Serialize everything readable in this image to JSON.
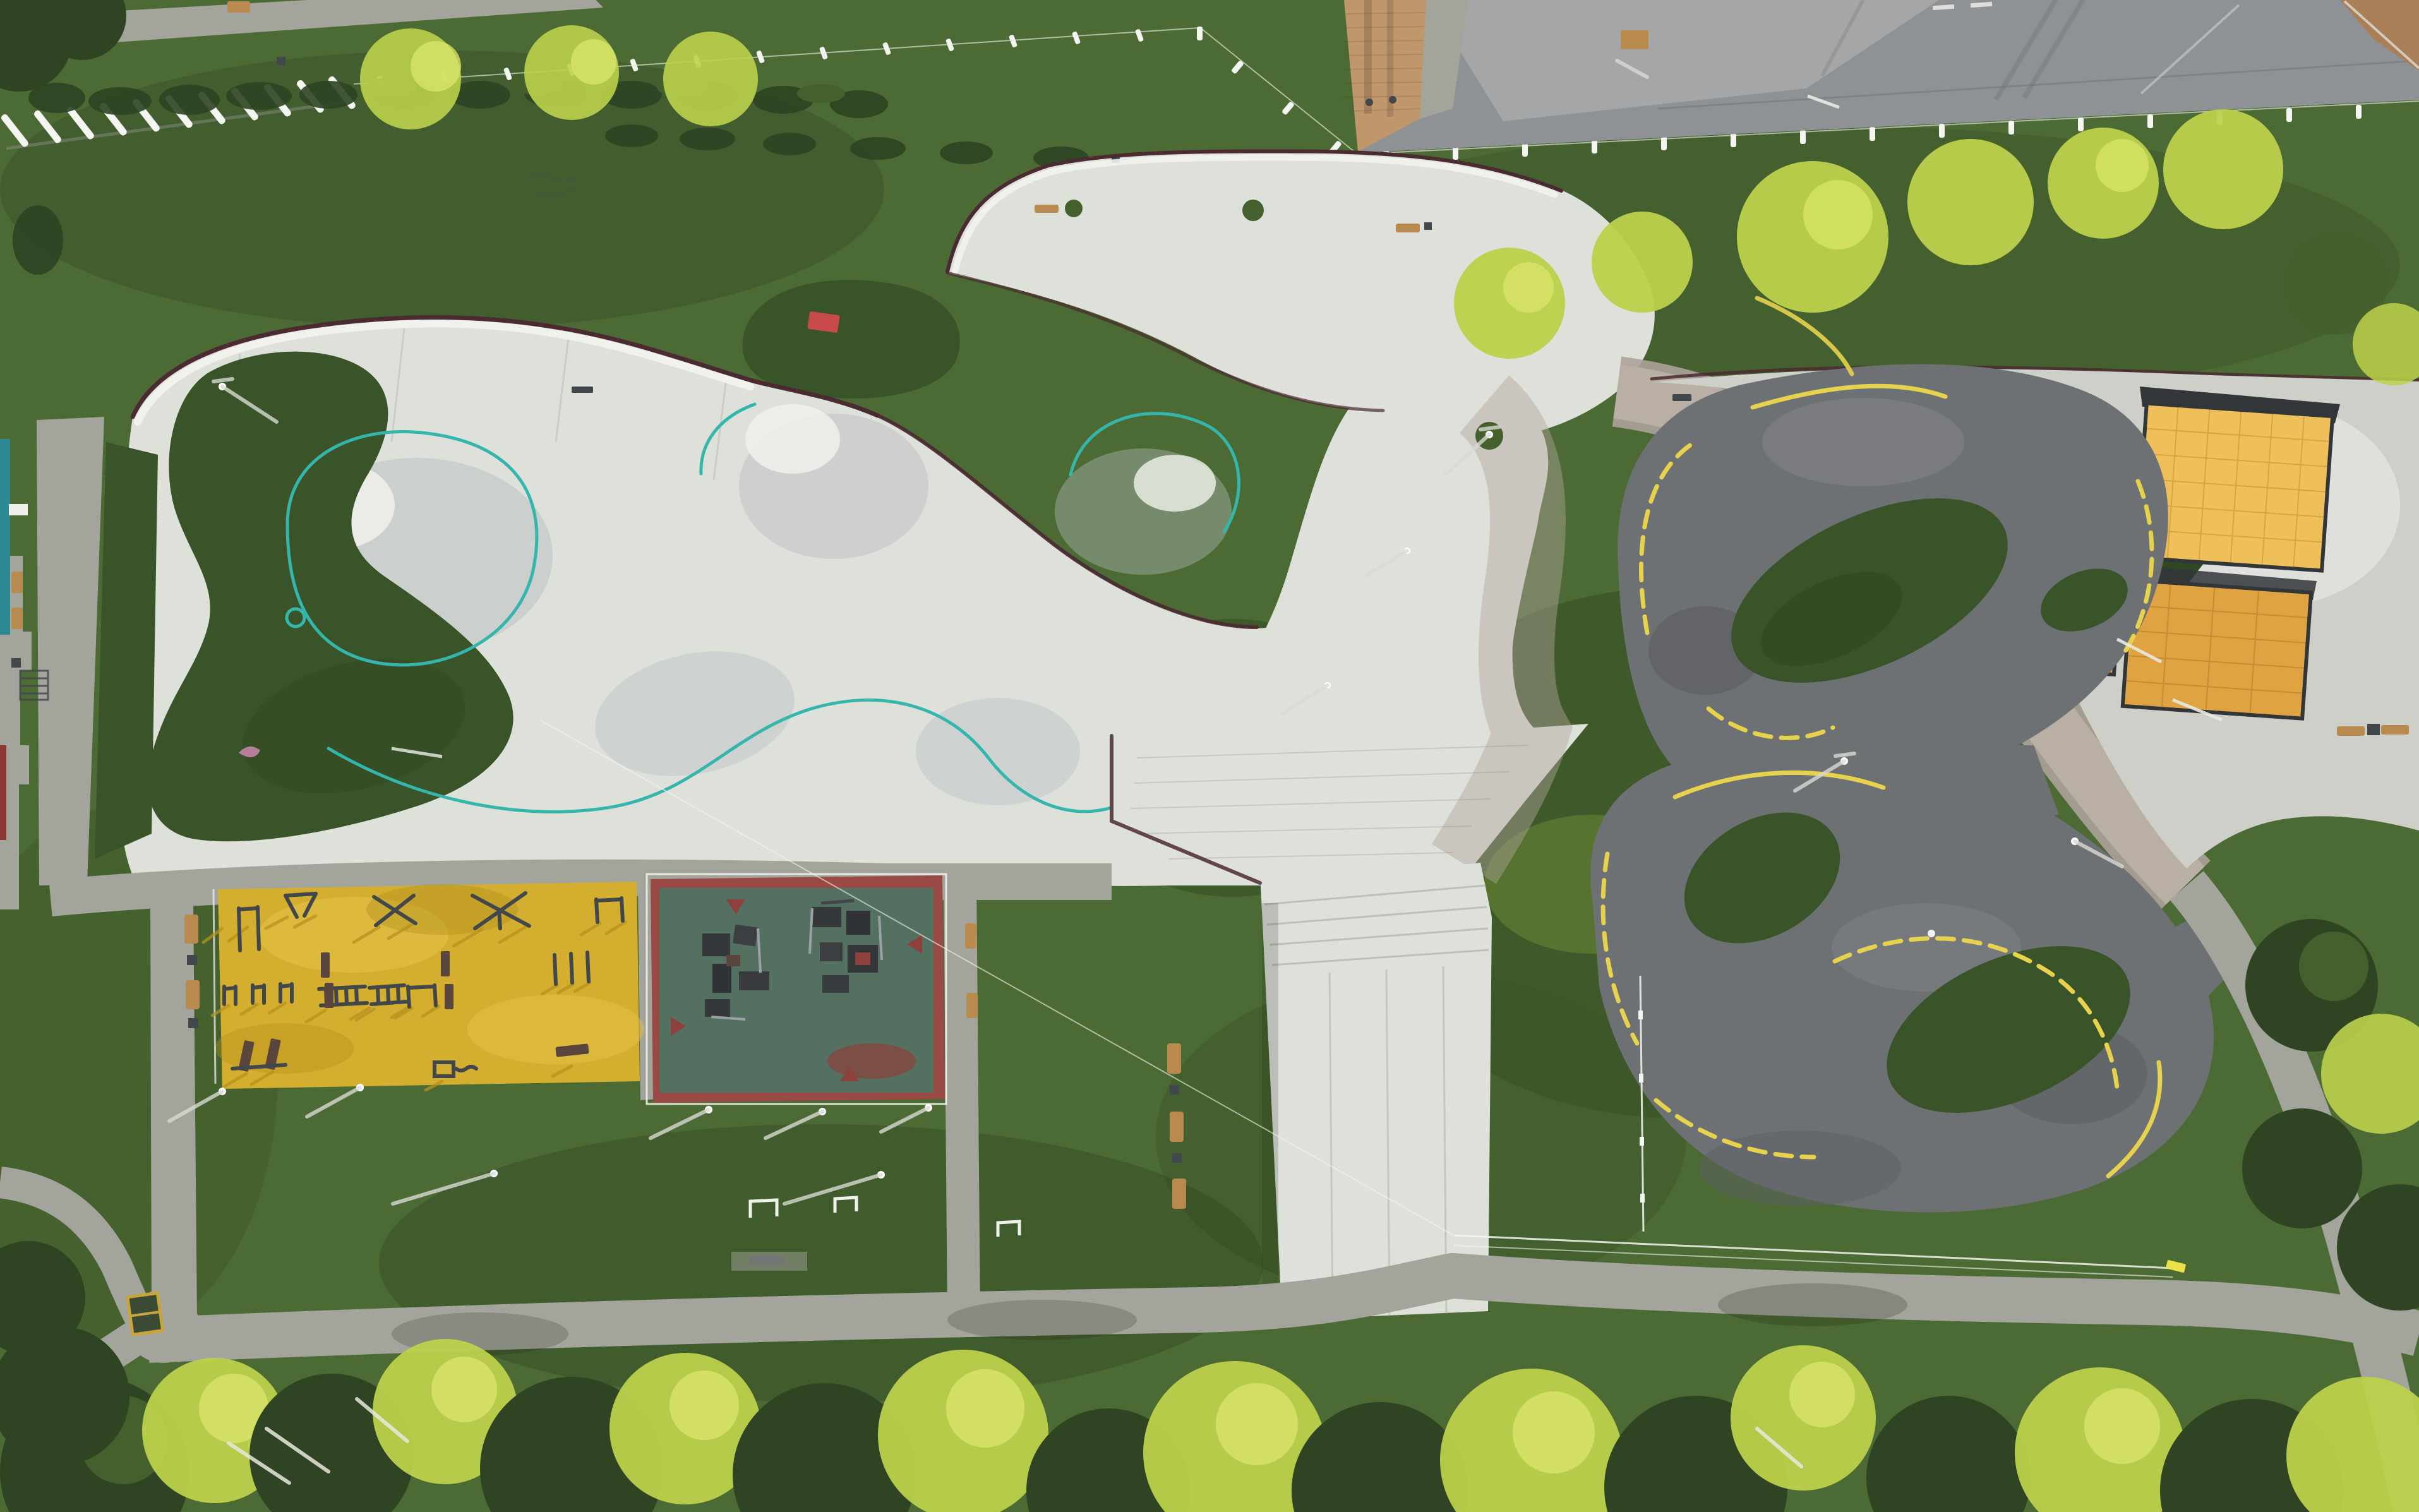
{
  "scene": {
    "type": "aerial-drone-photograph",
    "setting": "Top-down aerial view of an urban activity park: concrete skatepark with teal bowl lines, asphalt pump track with yellow lane markings, yellow outdoor-gym square, red rubber playground with green border, wooden pavilion decks, lawns, footpaths and tree rows at golden hour",
    "no_visible_text": true
  },
  "colors": {
    "grassBase": "#4c6a33",
    "grassDark": "#3a5429",
    "grassDeep": "#2f4722",
    "grassLit": "#8fae3c",
    "foliageLit": "#bcd14b",
    "foliageLitHi": "#d8e368",
    "foliageDark": "#2e4423",
    "foliageDarkHi": "#44602c",
    "concrete": "#dee0da",
    "concreteBright": "#f2f2ee",
    "concreteMid": "#cdcfc8",
    "concreteShade": "#b7bdc0",
    "pathGray": "#a3a49c",
    "walkGray": "#9b9c95",
    "roadAsphalt": "#8f9294",
    "roadLight": "#a6a9aa",
    "trackAsphalt": "#6e7174",
    "trackShade": "#5c5f63",
    "curbMaroon": "#4b2a32",
    "tealLine": "#35b6ad",
    "yellowLine": "#e7d24e",
    "playYellow": "#d4ae2e",
    "playYellowHi": "#e3c247",
    "playYellowSh": "#b5921f",
    "playRed": "#9a4a44",
    "playRedDeep": "#8d413c",
    "playGreen": "#547060",
    "equipDark": "#42474b",
    "equipBrown": "#5a463c",
    "woodBench": "#b98a4e",
    "pavilionWood": "#dfa441",
    "pavilionWoodHi": "#efc05a",
    "pavilionDark": "#323639",
    "brickTan": "#c0976a",
    "brickDark": "#a87f56",
    "fenceWhite": "#f4f4f0",
    "tealWall": "#2d8a94",
    "redStrip": "#8a3a30",
    "white": "#ffffff",
    "pinkPath": "#b2a59b"
  },
  "regions": [
    {
      "name": "skatepark",
      "surface": "light concrete with teal coping lines and maroon curb"
    },
    {
      "name": "pump-track-upper-loop",
      "surface": "dark asphalt with yellow dashed lines"
    },
    {
      "name": "pump-track-lower-loop",
      "surface": "dark asphalt with yellow dashed lines"
    },
    {
      "name": "outdoor-gym",
      "surface": "yellow rubber with steel calisthenics equipment"
    },
    {
      "name": "parkour-playground",
      "surface": "red rubber with green zigzag border and block obstacles"
    },
    {
      "name": "wooden-pavilion",
      "surface": "orange timber decks with dark railings"
    },
    {
      "name": "service-road",
      "surface": "gray asphalt, white picket fence along edge"
    },
    {
      "name": "footpaths",
      "surface": "gray concrete walkways with benches and lamps"
    },
    {
      "name": "lawns-and-trees",
      "surface": "green grass, sunlit tree canopies along borders"
    }
  ]
}
